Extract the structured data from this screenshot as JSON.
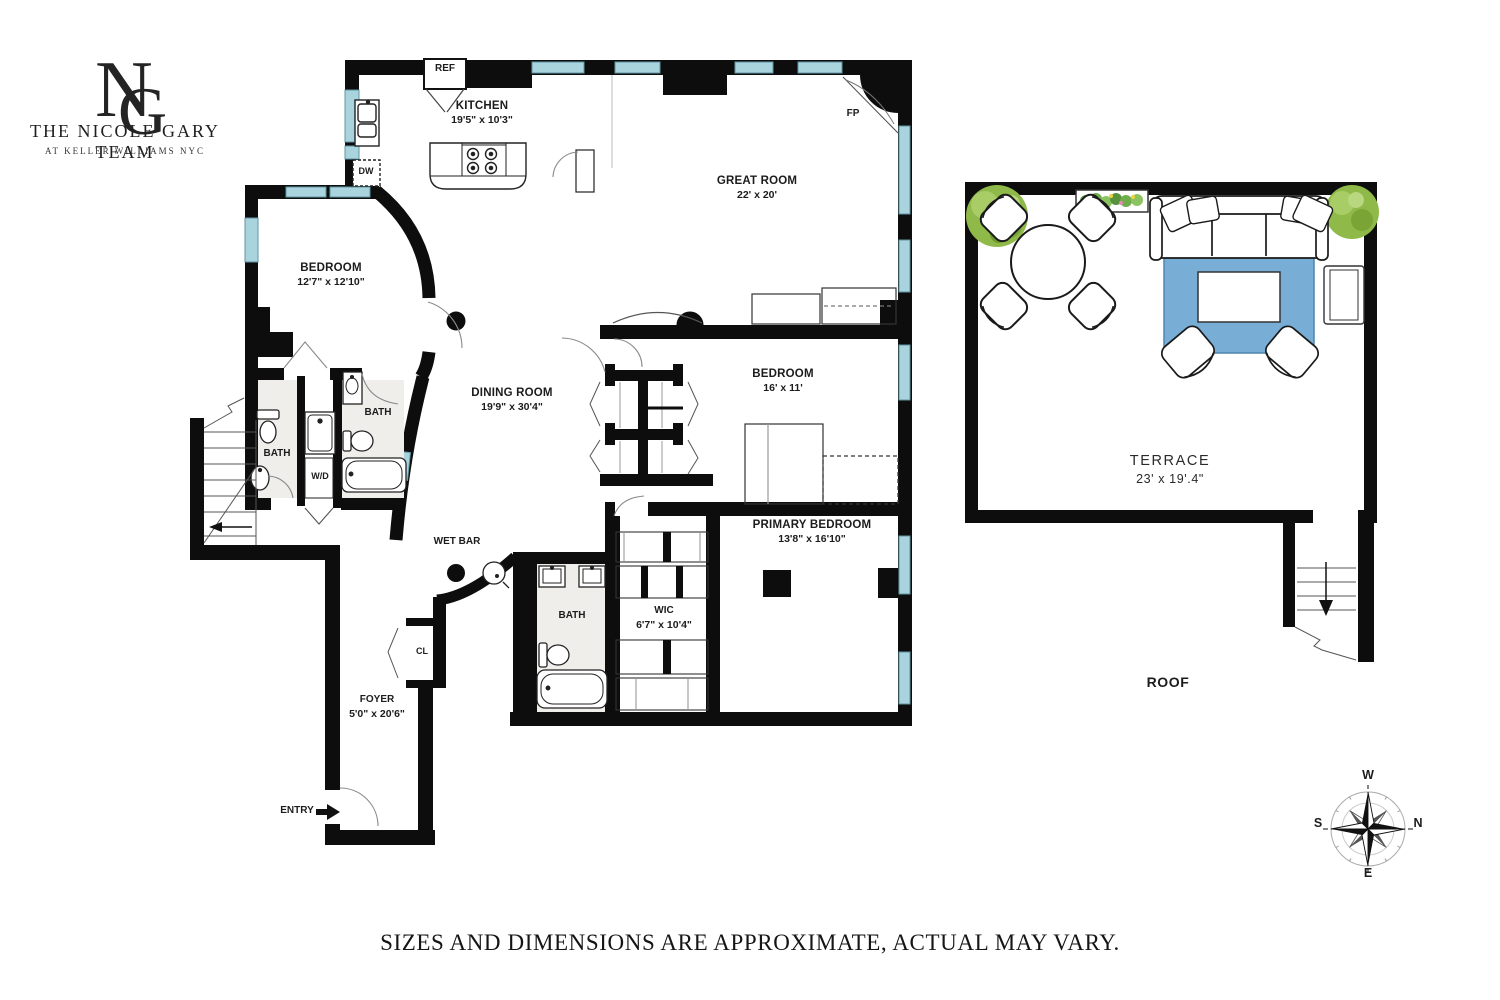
{
  "logo": {
    "monogram_n": "N",
    "monogram_g": "G",
    "team": "THE NICOLE GARY TEAM",
    "subtitle": "AT KELLER WILLIAMS NYC"
  },
  "plan": {
    "kitchen": {
      "name": "KITCHEN",
      "dims": "19'5\" x 10'3\""
    },
    "great_room": {
      "name": "GREAT ROOM",
      "dims": "22' x 20'"
    },
    "bedroom_a": {
      "name": "BEDROOM",
      "dims": "12'7\" x 12'10\""
    },
    "dining_room": {
      "name": "DINING ROOM",
      "dims": "19'9\" x 30'4\""
    },
    "bedroom_b": {
      "name": "BEDROOM",
      "dims": "16' x 11'"
    },
    "primary_bedroom": {
      "name": "PRIMARY BEDROOM",
      "dims": "13'8\" x 16'10\""
    },
    "wic": {
      "name": "WIC",
      "dims": "6'7\" x 10'4\""
    },
    "foyer": {
      "name": "FOYER",
      "dims": "5'0\" x 20'6\""
    },
    "bath_a": {
      "name": "BATH"
    },
    "bath_b": {
      "name": "BATH"
    },
    "bath_c": {
      "name": "BATH"
    }
  },
  "fixtures": {
    "ref": "REF",
    "dw": "DW",
    "fp": "FP",
    "wd": "W/D",
    "wet_bar": "WET BAR",
    "cl": "CL",
    "entry": "ENTRY"
  },
  "outdoor": {
    "terrace": {
      "name": "TERRACE",
      "dims": "23' x 19'.4\""
    },
    "roof": {
      "name": "ROOF"
    }
  },
  "compass": {
    "top": "W",
    "left": "S",
    "right": "N",
    "bottom": "E"
  },
  "footer": {
    "disclaimer": "SIZES AND DIMENSIONS ARE APPROXIMATE, ACTUAL MAY VARY."
  },
  "colors": {
    "wall": "#0d0d0d",
    "window": "#a9d4dd",
    "rug": "#78aed6",
    "tree": "#8fb949",
    "bath_floor": "#efeeea"
  }
}
